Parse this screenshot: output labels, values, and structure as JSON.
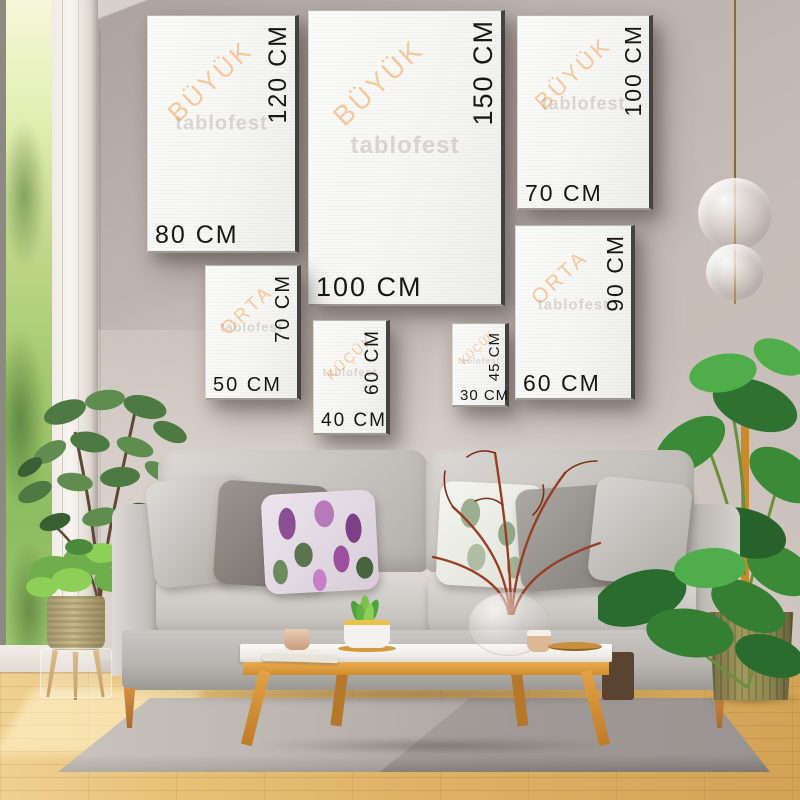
{
  "watermark": "tablofest",
  "frames": [
    {
      "category": "BÜYÜK",
      "height_label": "120 CM",
      "width_label": "80 CM"
    },
    {
      "category": "BÜYÜK",
      "height_label": "150 CM",
      "width_label": "100 CM"
    },
    {
      "category": "BÜYÜK",
      "height_label": "100 CM",
      "width_label": "70 CM"
    },
    {
      "category": "ORTA",
      "height_label": "70 CM",
      "width_label": "50 CM"
    },
    {
      "category": "KÜÇÜK",
      "height_label": "60 CM",
      "width_label": "40 CM"
    },
    {
      "category": "KÜÇÜK",
      "height_label": "45 CM",
      "width_label": "30 CM"
    },
    {
      "category": "ORTA",
      "height_label": "90 CM",
      "width_label": "60 CM"
    }
  ],
  "colors": {
    "category_label": "#f7c79c",
    "dimension_label": "#171717",
    "canvas": "#f6f6f4",
    "canvas_edge": "#45423f",
    "wall": "#bfb5b0",
    "sofa": "#c7c4c0",
    "wood": "#dd9a41",
    "rug": "#a29c99",
    "floor": "#deb164",
    "foliage": "#3e8f3b"
  }
}
